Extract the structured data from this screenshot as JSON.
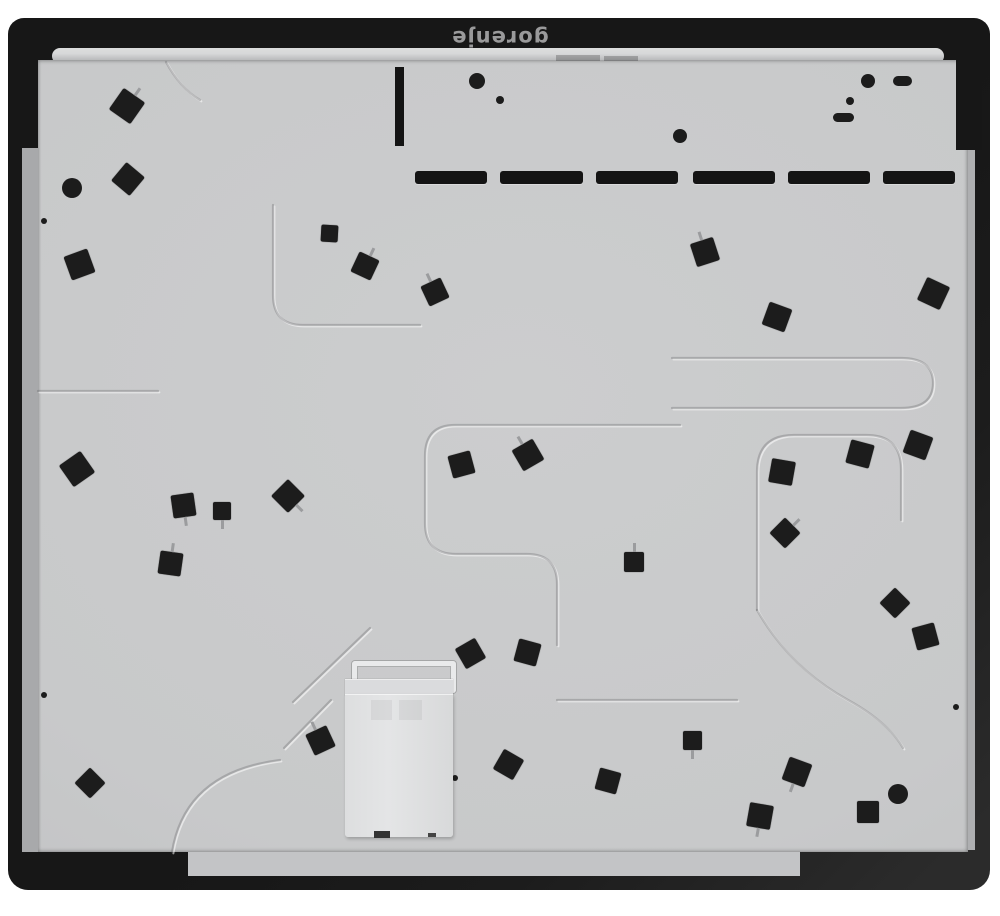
{
  "brand": {
    "logo_text": "gorenje"
  },
  "colors": {
    "bg": "#ffffff",
    "frame": "#171717",
    "frame_hl": "#2b2b2b",
    "glass_edge": "#a8a9ab",
    "band_hl": "#d7d8d9",
    "panel": "#c8c9ca",
    "panel_dark": "#bdbec0",
    "pad": "#1c1c1c",
    "box": "#e4e5e6",
    "logo": "#9a9a9b"
  },
  "features": {
    "vents": {
      "y": 171,
      "h": 13,
      "slots": [
        {
          "x": 415,
          "w": 72
        },
        {
          "x": 500,
          "w": 83
        },
        {
          "x": 596,
          "w": 82
        },
        {
          "x": 693,
          "w": 82
        },
        {
          "x": 788,
          "w": 82
        },
        {
          "x": 883,
          "w": 72
        }
      ]
    },
    "bar": {
      "x": 395,
      "y": 67,
      "w": 9,
      "h": 79
    },
    "tabs": [
      {
        "x": 556,
        "y": 55,
        "w": 44,
        "h": 6
      },
      {
        "x": 604,
        "y": 56,
        "w": 34,
        "h": 5
      }
    ],
    "pads": [
      {
        "x": 127,
        "y": 106,
        "s": 26,
        "r": 35,
        "stem": "up"
      },
      {
        "x": 128,
        "y": 179,
        "s": 24,
        "r": 40
      },
      {
        "x": 79,
        "y": 264,
        "s": 25,
        "r": -20
      },
      {
        "x": 329,
        "y": 233,
        "s": 17,
        "r": 3
      },
      {
        "x": 365,
        "y": 266,
        "s": 22,
        "r": 25,
        "stem": "up"
      },
      {
        "x": 435,
        "y": 292,
        "s": 22,
        "r": -25,
        "stem": "up"
      },
      {
        "x": 705,
        "y": 252,
        "s": 24,
        "r": -18,
        "stem": "up"
      },
      {
        "x": 777,
        "y": 317,
        "s": 24,
        "r": 20
      },
      {
        "x": 933,
        "y": 293,
        "s": 25,
        "r": 25
      },
      {
        "x": 77,
        "y": 469,
        "s": 26,
        "r": -35
      },
      {
        "x": 183,
        "y": 505,
        "s": 23,
        "r": -8,
        "stem": "down"
      },
      {
        "x": 222,
        "y": 511,
        "s": 18,
        "r": 0,
        "stem": "down"
      },
      {
        "x": 288,
        "y": 496,
        "s": 24,
        "r": 45,
        "stem": "right"
      },
      {
        "x": 170,
        "y": 563,
        "s": 23,
        "r": 8,
        "stem": "up"
      },
      {
        "x": 461,
        "y": 464,
        "s": 23,
        "r": -15
      },
      {
        "x": 528,
        "y": 455,
        "s": 24,
        "r": -30,
        "stem": "up"
      },
      {
        "x": 918,
        "y": 445,
        "s": 24,
        "r": 20
      },
      {
        "x": 860,
        "y": 454,
        "s": 24,
        "r": 15
      },
      {
        "x": 782,
        "y": 472,
        "s": 24,
        "r": 10
      },
      {
        "x": 785,
        "y": 533,
        "s": 22,
        "r": 45,
        "stem": "up"
      },
      {
        "x": 634,
        "y": 562,
        "s": 20,
        "r": 0,
        "stem": "up"
      },
      {
        "x": 895,
        "y": 603,
        "s": 22,
        "r": 45
      },
      {
        "x": 925,
        "y": 636,
        "s": 23,
        "r": -15
      },
      {
        "x": 470,
        "y": 653,
        "s": 23,
        "r": -30
      },
      {
        "x": 527,
        "y": 652,
        "s": 23,
        "r": 15
      },
      {
        "x": 320,
        "y": 740,
        "s": 23,
        "r": -25,
        "stem": "up"
      },
      {
        "x": 692,
        "y": 740,
        "s": 19,
        "r": 0,
        "stem": "down"
      },
      {
        "x": 508,
        "y": 764,
        "s": 23,
        "r": 30
      },
      {
        "x": 608,
        "y": 781,
        "s": 22,
        "r": 15
      },
      {
        "x": 90,
        "y": 783,
        "s": 22,
        "r": 45
      },
      {
        "x": 797,
        "y": 772,
        "s": 24,
        "r": 20,
        "stem": "down"
      },
      {
        "x": 760,
        "y": 816,
        "s": 24,
        "r": 10,
        "stem": "down"
      },
      {
        "x": 868,
        "y": 812,
        "s": 22,
        "r": 0
      }
    ],
    "dots": [
      {
        "x": 72,
        "y": 188,
        "r": 10
      },
      {
        "x": 477,
        "y": 81,
        "r": 8
      },
      {
        "x": 500,
        "y": 100,
        "r": 4
      },
      {
        "x": 680,
        "y": 136,
        "r": 7
      },
      {
        "x": 868,
        "y": 81,
        "r": 7
      },
      {
        "x": 850,
        "y": 101,
        "r": 4
      },
      {
        "x": 898,
        "y": 794,
        "r": 10
      },
      {
        "x": 44,
        "y": 221,
        "r": 3
      },
      {
        "x": 44,
        "y": 695,
        "r": 3
      },
      {
        "x": 455,
        "y": 778,
        "r": 3
      },
      {
        "x": 956,
        "y": 707,
        "r": 3
      }
    ],
    "pills": [
      {
        "x": 893,
        "y": 76,
        "w": 19,
        "h": 10
      },
      {
        "x": 833,
        "y": 113,
        "w": 21,
        "h": 9
      }
    ],
    "channels": [
      "M273 205 V295 Q273 325 303 325 H420",
      "M38 391 H158",
      "M166 62 Q180 88 200 100",
      "M680 425 H455 Q425 425 425 456 V523 Q425 554 456 554 H527 Q557 554 557 584 V645",
      "M672 358 H901 Q933 358 933 383 Q933 408 901 408 H672",
      "M757 610 V472 Q757 435 794 435 H866 Q901 435 901 469 V520",
      "M757 610 Q790 668 848 700 Q888 722 903 748",
      "M280 760 Q185 772 172 852",
      "M557 700 H737",
      "M370 628 L293 702",
      "M331 700 L284 748"
    ]
  }
}
